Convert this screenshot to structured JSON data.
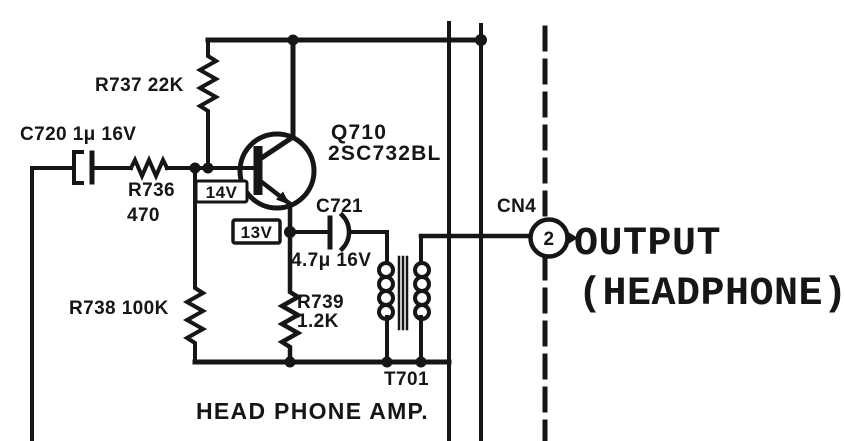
{
  "schematic": {
    "caption": "HEAD PHONE AMP.",
    "labels": {
      "c720": "C720 1μ 16V",
      "r737": "R737 22K",
      "r736_name": "R736",
      "r736_value": "470",
      "q710_name": "Q710",
      "q710_part": "2SC732BL",
      "v_base": "14V",
      "v_emitter": "13V",
      "c721_name": "C721",
      "c721_value": "4.7μ 16V",
      "r738": "R738 100K",
      "r739_name": "R739",
      "r739_value": "1.2K",
      "t701": "T701",
      "cn4": "CN4",
      "pin2": "2",
      "output_line1": "OUTPUT",
      "output_line2": "(HEADPHONE)"
    },
    "colors": {
      "ink": "#161616",
      "paper": "#ffffff"
    }
  }
}
